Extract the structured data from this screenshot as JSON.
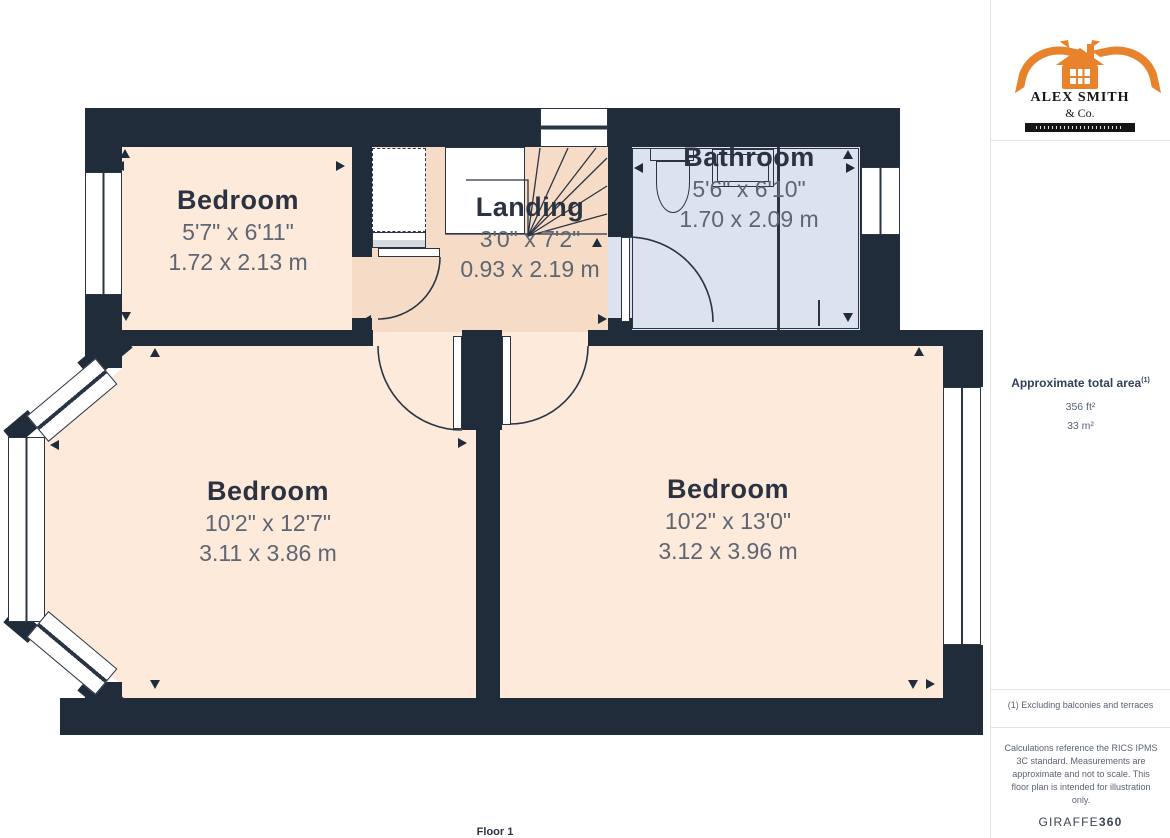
{
  "floorplan": {
    "floor_label": "Floor 1",
    "rooms": [
      {
        "id": "bedroom-top-left",
        "name": "Bedroom",
        "imperial": "5'7\" x 6'11\"",
        "metric": "1.72 x 2.13 m"
      },
      {
        "id": "landing",
        "name": "Landing",
        "imperial": "3'0\" x 7'2\"",
        "metric": "0.93 x 2.19 m"
      },
      {
        "id": "bathroom",
        "name": "Bathroom",
        "imperial": "5'6\" x 6'10\"",
        "metric": "1.70 x 2.09 m"
      },
      {
        "id": "bedroom-bottom-left",
        "name": "Bedroom",
        "imperial": "10'2\" x 12'7\"",
        "metric": "3.11 x 3.86 m"
      },
      {
        "id": "bedroom-bottom-right",
        "name": "Bedroom",
        "imperial": "10'2\" x 13'0\"",
        "metric": "3.12 x 3.96 m"
      }
    ],
    "colors": {
      "wall": "#212c3b",
      "bedroom_floor": "#fdeada",
      "landing_floor": "#f6dcc6",
      "bathroom_floor": "#dde3ee",
      "line": "#2a3443"
    }
  },
  "sidebar": {
    "logo": {
      "line1": "ALEX SMITH",
      "line2": "& Co.",
      "accent": "#e8832c"
    },
    "area": {
      "label": "Approximate total area",
      "superscript": "(1)",
      "value_imperial": "356 ft²",
      "value_metric": "33 m²"
    },
    "footnote": "(1) Excluding balconies and terraces",
    "disclaimer": "Calculations reference the RICS IPMS 3C standard. Measurements are approximate and not to scale. This floor plan is intended for illustration only.",
    "brand": {
      "name": "GIRAFFE",
      "suffix": "360"
    }
  }
}
